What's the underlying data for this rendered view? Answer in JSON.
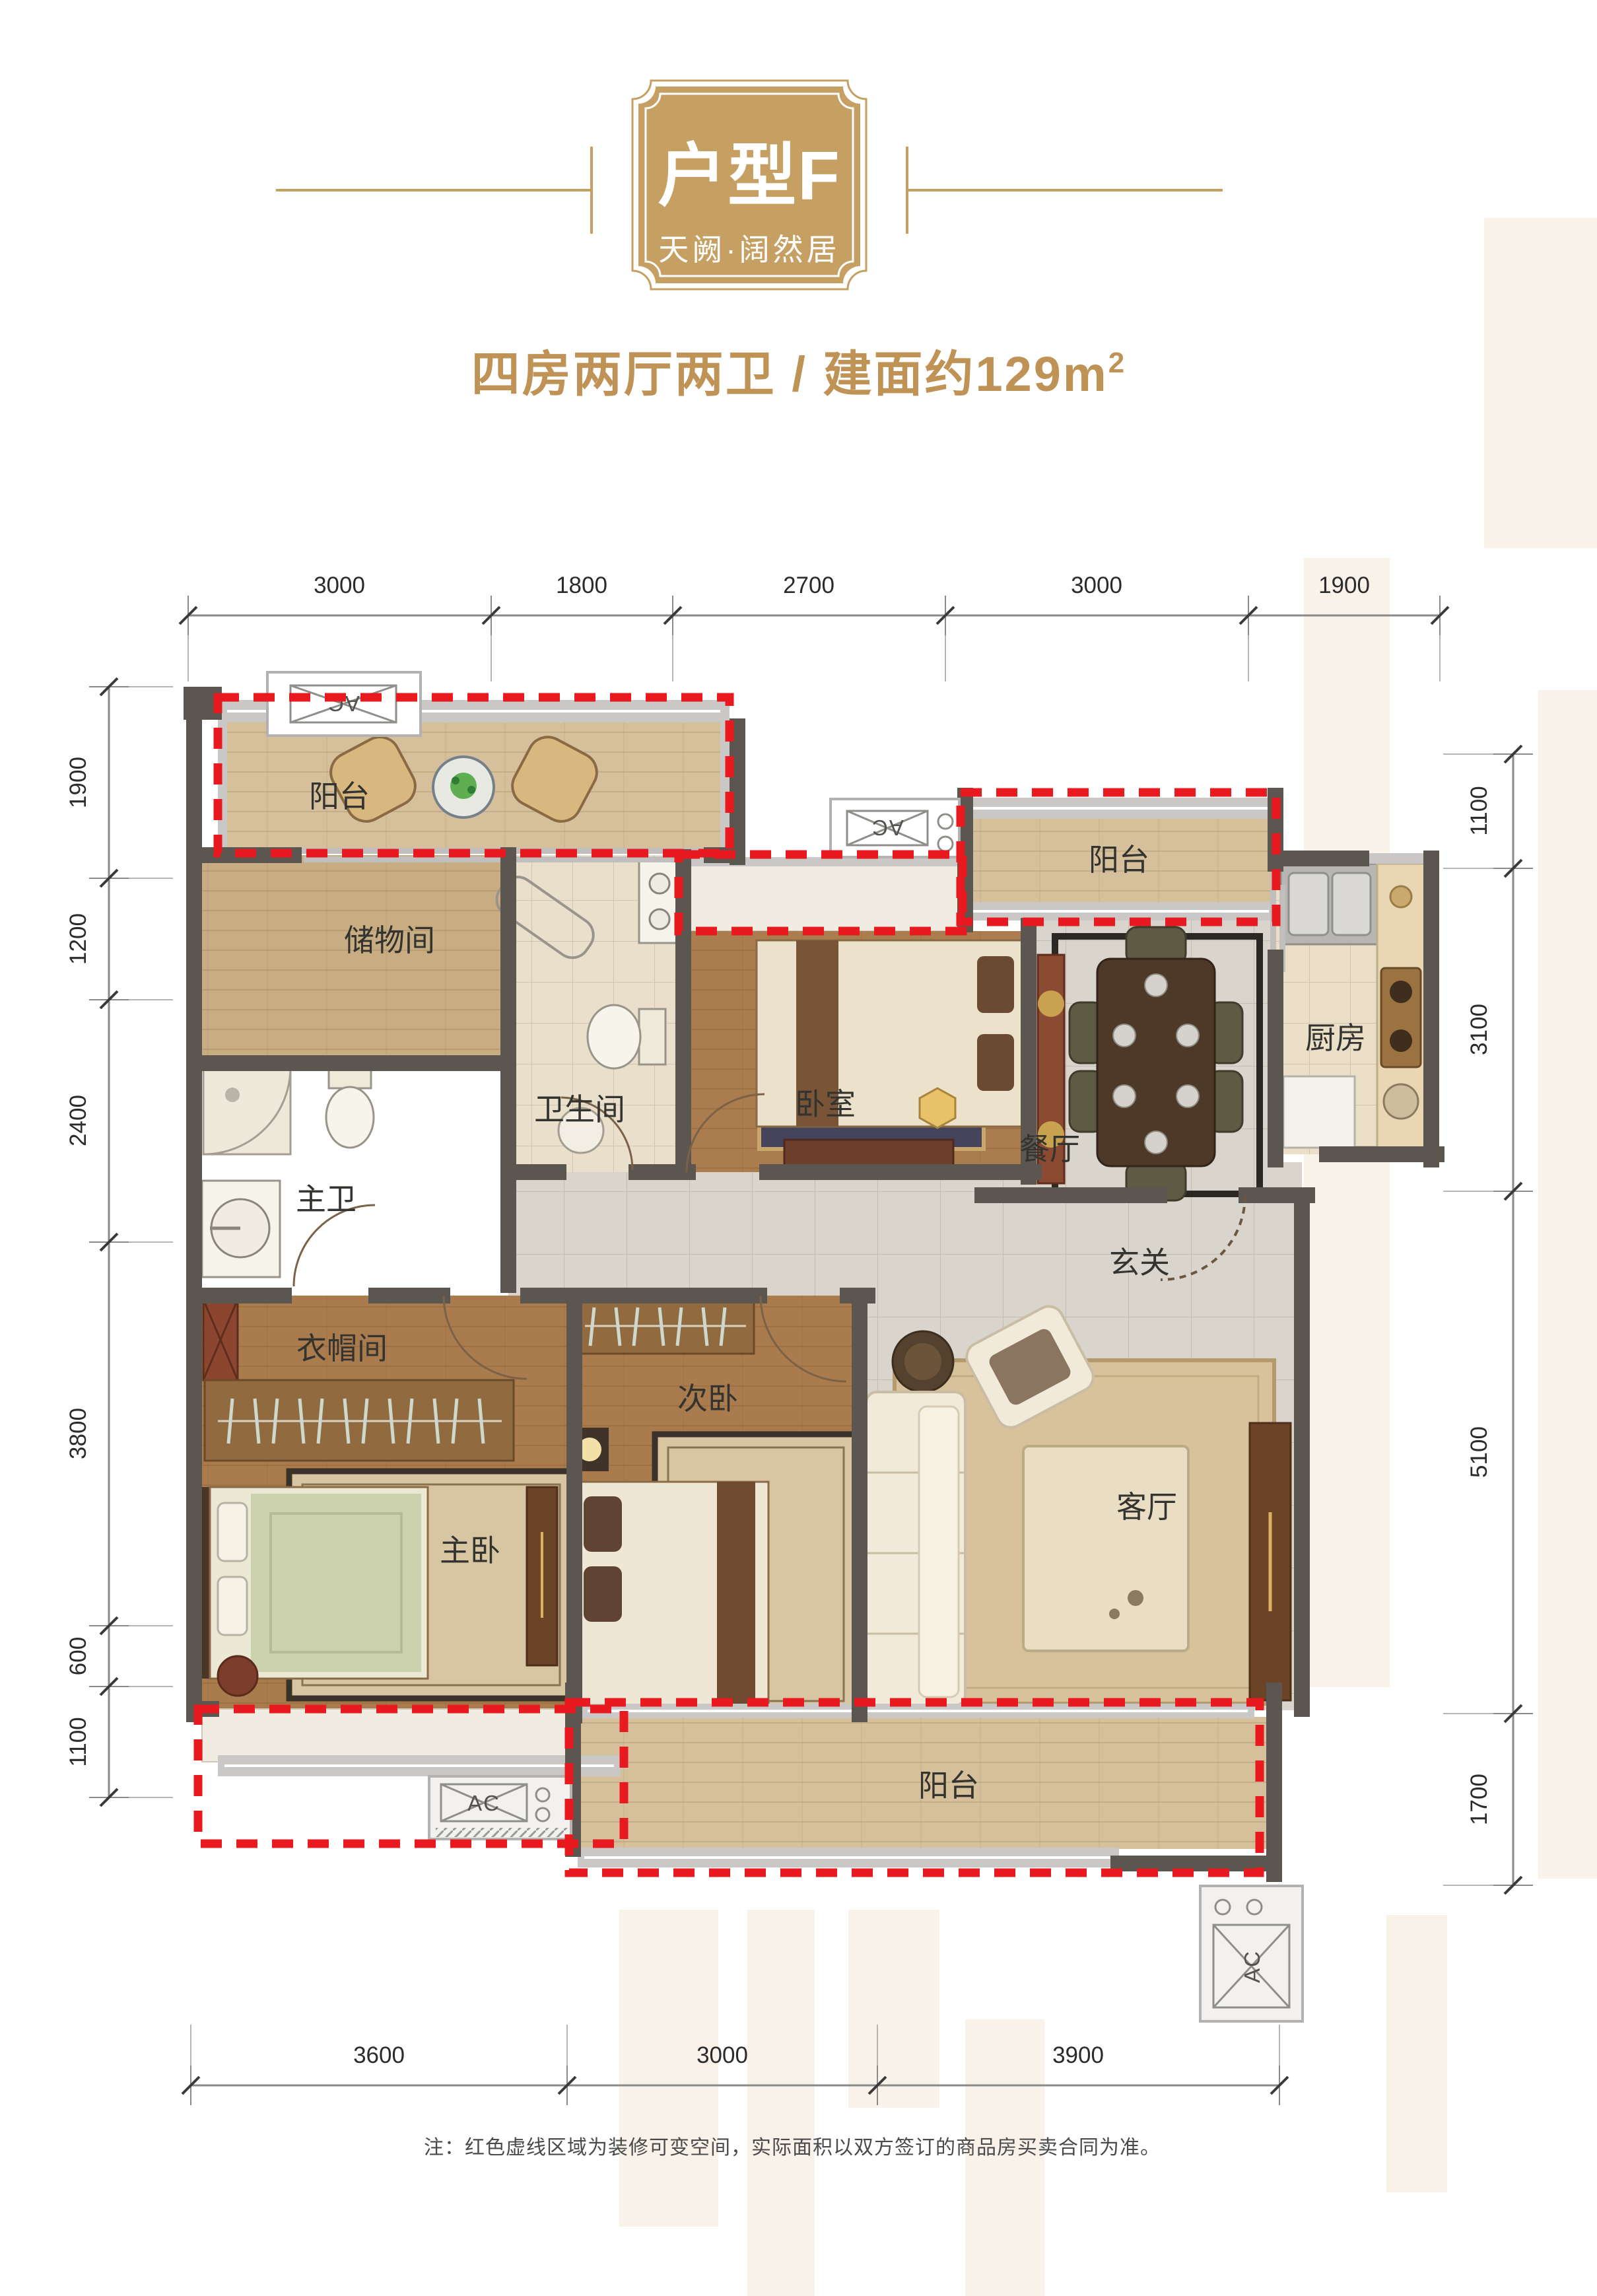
{
  "header": {
    "unit_title": "户型F",
    "project_name": "天阙·阔然居",
    "subtitle": {
      "rooms": "四房两厅两卫",
      "separator": " / ",
      "area": "建面约129m",
      "area_sup": "2"
    }
  },
  "plan": {
    "rooms": {
      "balcony_top_left": "阳台",
      "storage": "储物间",
      "bathroom": "卫生间",
      "bedroom": "卧室",
      "balcony_top_right": "阳台",
      "kitchen": "厨房",
      "dining": "餐厅",
      "master_bath": "主卫",
      "foyer": "玄关",
      "cloakroom": "衣帽间",
      "second_bedroom": "次卧",
      "master_bedroom": "主卧",
      "living_room": "客厅",
      "balcony_bottom": "阳台"
    },
    "ac_label": "AC",
    "dimensions": {
      "top": [
        "3000",
        "1800",
        "2700",
        "3000",
        "1900"
      ],
      "left": [
        "1900",
        "1200",
        "2400",
        "3800",
        "600",
        "1100"
      ],
      "right": [
        "1100",
        "3100",
        "5100",
        "1700"
      ],
      "bottom": [
        "3600",
        "3000",
        "3900"
      ]
    },
    "colors": {
      "red_dashed": "#e8191f",
      "gold": "#c5a063",
      "wall": "#5b5650"
    }
  },
  "footer": {
    "note": "注：红色虚线区域为装修可变空间，实际面积以双方签订的商品房买卖合同为准。"
  }
}
